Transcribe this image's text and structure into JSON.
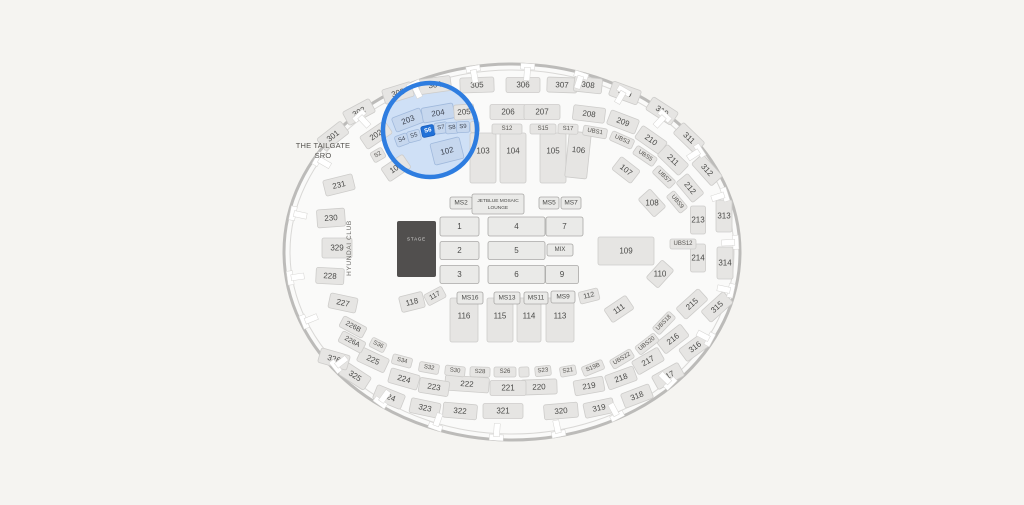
{
  "map": {
    "labels": {
      "tailgate_line1": "THE TAILGATE",
      "tailgate_line2": "SRO",
      "hyundai_club": "HYUNDAI CLUB"
    },
    "selected_section": "S6",
    "colors": {
      "background": "#f5f4f1",
      "interior": "#fafaf9",
      "wall": "#bcbbb9",
      "wall_inner": "#d9d8d6",
      "section_fill": "#e6e5e3",
      "section_stroke": "#cdccca",
      "floor_fill": "#eaeae8",
      "floor_stroke": "#a9a8a6",
      "label_text": "#4a4a48",
      "highlight_fill": "#c6d7ee",
      "highlight_stroke": "#a0b9dc",
      "selected_fill": "#2171d8",
      "selected_stroke": "#1b5fbd",
      "selected_text": "#ffffff",
      "ring_blue": "#2e7de0",
      "ring_tint": "#cfe0f6",
      "stage_fill": "#514f4e",
      "stage_text": "#dddddc"
    },
    "highlight": {
      "cx": 430,
      "cy": 130,
      "r": 47
    },
    "sections": {
      "level300": [
        {
          "t": "301",
          "x": 333,
          "y": 136,
          "r": -38
        },
        {
          "t": "302",
          "x": 359,
          "y": 112,
          "r": -28
        },
        {
          "t": "303",
          "x": 398,
          "y": 93,
          "r": -17
        },
        {
          "t": "304",
          "x": 435,
          "y": 85,
          "r": -8,
          "w": 32
        },
        {
          "t": "305",
          "x": 477,
          "y": 85,
          "r": -2,
          "w": 34
        },
        {
          "t": "306",
          "x": 523,
          "y": 85,
          "r": 0,
          "w": 34
        },
        {
          "t": "307",
          "x": 562,
          "y": 85,
          "r": 2,
          "w": 30
        },
        {
          "t": "308",
          "x": 588,
          "y": 85,
          "r": 6,
          "w": 28
        },
        {
          "t": "309",
          "x": 625,
          "y": 93,
          "r": 20
        },
        {
          "t": "310",
          "x": 662,
          "y": 111,
          "r": 33
        },
        {
          "t": "311",
          "x": 689,
          "y": 138,
          "r": 44
        },
        {
          "t": "312",
          "x": 707,
          "y": 170,
          "r": 48
        },
        {
          "t": "313",
          "x": 724,
          "y": 216,
          "r": 0,
          "w": 16,
          "h": 32
        },
        {
          "t": "314",
          "x": 725,
          "y": 263,
          "r": 0,
          "w": 16,
          "h": 32
        },
        {
          "t": "315",
          "x": 717,
          "y": 307,
          "r": -42
        },
        {
          "t": "316",
          "x": 695,
          "y": 347,
          "r": -36
        },
        {
          "t": "317",
          "x": 668,
          "y": 376,
          "r": -29
        },
        {
          "t": "318",
          "x": 637,
          "y": 396,
          "r": -21
        },
        {
          "t": "319",
          "x": 599,
          "y": 408,
          "r": -12
        },
        {
          "t": "320",
          "x": 561,
          "y": 411,
          "r": -5,
          "w": 34
        },
        {
          "t": "321",
          "x": 503,
          "y": 411,
          "r": 0,
          "w": 40
        },
        {
          "t": "322",
          "x": 460,
          "y": 411,
          "r": 5,
          "w": 34
        },
        {
          "t": "323",
          "x": 425,
          "y": 408,
          "r": 12
        },
        {
          "t": "324",
          "x": 389,
          "y": 397,
          "r": 22
        },
        {
          "t": "325",
          "x": 355,
          "y": 376,
          "r": 33
        },
        {
          "t": "326",
          "x": 334,
          "y": 359,
          "r": 16
        },
        {
          "t": "329",
          "x": 337,
          "y": 248,
          "r": 0,
          "w": 30,
          "h": 20
        }
      ],
      "level200": [
        {
          "t": "202",
          "x": 376,
          "y": 135,
          "r": -34
        },
        {
          "t": "203",
          "x": 408,
          "y": 120,
          "r": -21,
          "c": "hl"
        },
        {
          "t": "204",
          "x": 438,
          "y": 113,
          "r": -10,
          "w": 32,
          "c": "hl"
        },
        {
          "t": "205",
          "x": 464,
          "y": 112,
          "r": -4,
          "w": 20
        },
        {
          "t": "206",
          "x": 508,
          "y": 112,
          "r": 0,
          "w": 36
        },
        {
          "t": "207",
          "x": 542,
          "y": 112,
          "r": 0,
          "w": 36
        },
        {
          "t": "208",
          "x": 589,
          "y": 114,
          "r": 7,
          "w": 32
        },
        {
          "t": "209",
          "x": 623,
          "y": 122,
          "r": 21
        },
        {
          "t": "210",
          "x": 651,
          "y": 140,
          "r": 35
        },
        {
          "t": "211",
          "x": 673,
          "y": 160,
          "r": 44
        },
        {
          "t": "212",
          "x": 690,
          "y": 188,
          "r": 50,
          "w": 26
        },
        {
          "t": "213",
          "x": 698,
          "y": 220,
          "r": 0,
          "w": 15,
          "h": 28
        },
        {
          "t": "214",
          "x": 698,
          "y": 258,
          "r": 0,
          "w": 15,
          "h": 28
        },
        {
          "t": "215",
          "x": 692,
          "y": 304,
          "r": -42
        },
        {
          "t": "216",
          "x": 673,
          "y": 339,
          "r": -38
        },
        {
          "t": "217",
          "x": 648,
          "y": 361,
          "r": -30
        },
        {
          "t": "218",
          "x": 621,
          "y": 378,
          "r": -20
        },
        {
          "t": "219",
          "x": 589,
          "y": 386,
          "r": -10
        },
        {
          "t": "220",
          "x": 539,
          "y": 387,
          "r": -2,
          "w": 36
        },
        {
          "t": "221",
          "x": 508,
          "y": 388,
          "r": 0,
          "w": 36
        },
        {
          "t": "222",
          "x": 467,
          "y": 384,
          "r": 4,
          "w": 44
        },
        {
          "t": "223",
          "x": 434,
          "y": 387,
          "r": 9
        },
        {
          "t": "224",
          "x": 404,
          "y": 379,
          "r": 16
        },
        {
          "t": "225",
          "x": 373,
          "y": 360,
          "r": 25
        },
        {
          "t": "226A",
          "x": 352,
          "y": 342,
          "r": 28,
          "w": 26,
          "h": 12,
          "fs": 7
        },
        {
          "t": "226B",
          "x": 353,
          "y": 327,
          "r": 28,
          "w": 26,
          "h": 12,
          "fs": 7
        },
        {
          "t": "227",
          "x": 343,
          "y": 303,
          "r": 12,
          "w": 28
        },
        {
          "t": "228",
          "x": 330,
          "y": 276,
          "r": 3,
          "w": 28,
          "h": 16
        },
        {
          "t": "230",
          "x": 331,
          "y": 218,
          "r": -4,
          "w": 28,
          "h": 18
        },
        {
          "t": "231",
          "x": 339,
          "y": 185,
          "r": -14,
          "w": 30,
          "h": 16
        }
      ],
      "suites_top": [
        {
          "t": "S2",
          "x": 378,
          "y": 155,
          "r": -30
        },
        {
          "t": "S4",
          "x": 402,
          "y": 140,
          "r": -20,
          "c": "hl"
        },
        {
          "t": "S5",
          "x": 414,
          "y": 136,
          "r": -15,
          "c": "hl"
        },
        {
          "t": "S6",
          "x": 428,
          "y": 131,
          "r": -12,
          "c": "sel"
        },
        {
          "t": "S7",
          "x": 441,
          "y": 128,
          "r": -8,
          "c": "hl"
        },
        {
          "t": "S8",
          "x": 452,
          "y": 128,
          "r": -5,
          "c": "hl"
        },
        {
          "t": "S9",
          "x": 463,
          "y": 127,
          "r": -3,
          "c": "hl"
        },
        {
          "t": "",
          "x": 475,
          "y": 127,
          "r": -2,
          "w": 9
        },
        {
          "t": "S12",
          "x": 507,
          "y": 129,
          "r": 0,
          "w": 30,
          "h": 10
        },
        {
          "t": "S15",
          "x": 543,
          "y": 129,
          "r": 0,
          "w": 26,
          "h": 10
        },
        {
          "t": "S17",
          "x": 568,
          "y": 129,
          "r": 2,
          "w": 20,
          "h": 10
        }
      ],
      "suites_ubs": [
        {
          "t": "UBS1",
          "x": 595,
          "y": 132,
          "r": 10
        },
        {
          "t": "UBS3",
          "x": 622,
          "y": 140,
          "r": 24
        },
        {
          "t": "UBS5",
          "x": 645,
          "y": 156,
          "r": 34
        },
        {
          "t": "UBS7",
          "x": 664,
          "y": 177,
          "r": 44
        },
        {
          "t": "UBS9",
          "x": 677,
          "y": 202,
          "r": 50,
          "w": 22
        },
        {
          "t": "UBS12",
          "x": 683,
          "y": 244,
          "r": 0,
          "w": 26
        },
        {
          "t": "UBS18",
          "x": 664,
          "y": 323,
          "r": -46
        },
        {
          "t": "UBS20",
          "x": 647,
          "y": 344,
          "r": -38
        },
        {
          "t": "UBS22",
          "x": 622,
          "y": 359,
          "r": -31
        }
      ],
      "suites_bottom": [
        {
          "t": "S19B",
          "x": 593,
          "y": 368,
          "r": -22,
          "w": 22
        },
        {
          "t": "S21",
          "x": 568,
          "y": 371,
          "r": -10,
          "w": 16
        },
        {
          "t": "S23",
          "x": 543,
          "y": 371,
          "r": -6,
          "w": 16
        },
        {
          "t": "",
          "x": 524,
          "y": 372,
          "r": -2,
          "w": 10
        },
        {
          "t": "S26",
          "x": 505,
          "y": 372,
          "r": 0,
          "w": 22
        },
        {
          "t": "S28",
          "x": 480,
          "y": 372,
          "r": 2,
          "w": 20
        },
        {
          "t": "S30",
          "x": 455,
          "y": 371,
          "r": 6,
          "w": 20
        },
        {
          "t": "S32",
          "x": 429,
          "y": 368,
          "r": 10,
          "w": 20
        },
        {
          "t": "S34",
          "x": 402,
          "y": 361,
          "r": 15,
          "w": 20
        },
        {
          "t": "S36",
          "x": 378,
          "y": 345,
          "r": 27,
          "w": 16
        }
      ],
      "level100": [
        {
          "t": "101",
          "x": 396,
          "y": 168,
          "r": -34
        },
        {
          "t": "102",
          "x": 447,
          "y": 151,
          "r": -14,
          "w": 30,
          "h": 22,
          "c": "hl"
        },
        {
          "t": "103",
          "x": 483,
          "y": 158,
          "r": 0,
          "w": 26,
          "h": 50
        },
        {
          "t": "104",
          "x": 513,
          "y": 158,
          "r": 0,
          "w": 26,
          "h": 50
        },
        {
          "t": "105",
          "x": 553,
          "y": 158,
          "r": 0,
          "w": 26,
          "h": 50
        },
        {
          "t": "106",
          "x": 578,
          "y": 155,
          "r": 6,
          "w": 22,
          "h": 46
        },
        {
          "t": "107",
          "x": 626,
          "y": 170,
          "r": 38,
          "w": 24
        },
        {
          "t": "108",
          "x": 652,
          "y": 203,
          "r": 48,
          "w": 24,
          "ht": 1
        },
        {
          "t": "109",
          "x": 626,
          "y": 251,
          "r": 0,
          "w": 56,
          "h": 28
        },
        {
          "t": "110",
          "x": 660,
          "y": 274,
          "r": -48,
          "w": 24,
          "ht": 1
        },
        {
          "t": "111",
          "x": 619,
          "y": 309,
          "r": -34
        },
        {
          "t": "112",
          "x": 589,
          "y": 296,
          "r": -14,
          "w": 20,
          "h": 12,
          "fs": 7
        },
        {
          "t": "113",
          "x": 560,
          "y": 320,
          "r": 0,
          "w": 28,
          "h": 44
        },
        {
          "t": "114",
          "x": 529,
          "y": 320,
          "r": 0,
          "w": 24,
          "h": 44
        },
        {
          "t": "115",
          "x": 500,
          "y": 320,
          "r": 0,
          "w": 26,
          "h": 44
        },
        {
          "t": "116",
          "x": 464,
          "y": 320,
          "r": 0,
          "w": 28,
          "h": 44
        },
        {
          "t": "117",
          "x": 435,
          "y": 296,
          "r": -28,
          "w": 20,
          "h": 12,
          "fs": 7
        },
        {
          "t": "118",
          "x": 412,
          "y": 302,
          "r": -14,
          "w": 24
        }
      ],
      "floor": [
        {
          "t": "MS2",
          "x": 461,
          "y": 203,
          "w": 22,
          "h": 12,
          "fs": 6.5
        },
        {
          "t": "JETBLUE MOSAIC",
          "t2": "LOUNGE",
          "x": 498,
          "y": 204,
          "w": 52,
          "h": 20,
          "fs": 4.8
        },
        {
          "t": "MS5",
          "x": 549,
          "y": 203,
          "w": 20,
          "h": 12,
          "fs": 6.5
        },
        {
          "t": "MS7",
          "x": 571,
          "y": 203,
          "w": 20,
          "h": 12,
          "fs": 6.5
        },
        {
          "t": "1",
          "x": 459.5,
          "y": 226.5,
          "w": 39,
          "h": 19
        },
        {
          "t": "4",
          "x": 516.5,
          "y": 226.5,
          "w": 57,
          "h": 19
        },
        {
          "t": "7",
          "x": 564.5,
          "y": 226.5,
          "w": 37,
          "h": 19
        },
        {
          "t": "2",
          "x": 459.5,
          "y": 250.5,
          "w": 39,
          "h": 18
        },
        {
          "t": "5",
          "x": 516.5,
          "y": 250.5,
          "w": 57,
          "h": 18
        },
        {
          "t": "MIX",
          "x": 560,
          "y": 250,
          "w": 26,
          "h": 12,
          "fs": 6
        },
        {
          "t": "3",
          "x": 459.5,
          "y": 274.5,
          "w": 39,
          "h": 18
        },
        {
          "t": "6",
          "x": 516.5,
          "y": 274.5,
          "w": 57,
          "h": 18
        },
        {
          "t": "9",
          "x": 562,
          "y": 274.5,
          "w": 33,
          "h": 18
        },
        {
          "t": "MS16",
          "x": 470,
          "y": 298,
          "w": 26,
          "h": 12,
          "fs": 6.5
        },
        {
          "t": "MS13",
          "x": 507,
          "y": 298,
          "w": 26,
          "h": 12,
          "fs": 6.5
        },
        {
          "t": "MS11",
          "x": 536,
          "y": 298,
          "w": 24,
          "h": 12,
          "fs": 6.5
        },
        {
          "t": "MS9",
          "x": 563,
          "y": 297,
          "w": 24,
          "h": 12,
          "fs": 6.5
        },
        {
          "t": "STAGE",
          "x": 416.5,
          "y": 249,
          "w": 39,
          "h": 56,
          "c": "stage",
          "fs": 4.5
        }
      ]
    },
    "aisle_marker_angles": [
      -168,
      -150,
      -133,
      -116,
      -100,
      -86,
      -72,
      -60,
      -47,
      -33,
      -18,
      -3,
      12,
      28,
      45,
      62,
      78,
      94,
      110,
      126,
      142,
      158,
      172
    ]
  }
}
